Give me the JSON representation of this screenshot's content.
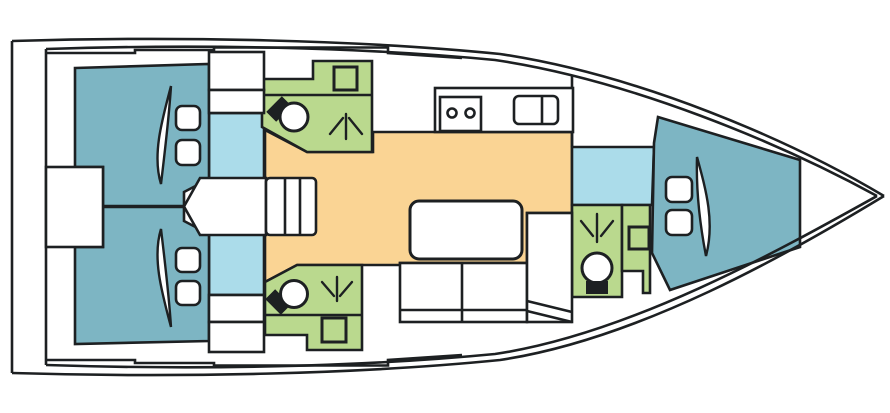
{
  "diagram": {
    "type": "yacht-deck-plan",
    "orientation": "bow-right"
  },
  "colors": {
    "outline": "#1d2022",
    "cabin": "#7db5c3",
    "passage": "#abdcea",
    "head": "#bad98e",
    "saloon": "#fad494",
    "furniture": "#ffffff",
    "background": "#ffffff"
  },
  "icons": {
    "toilet": "toilet-icon",
    "shower": "shower-spray-icon",
    "sink": "sink-icon",
    "stove": "stove-two-burner-icon",
    "galley_sink": "double-sink-icon",
    "steps": "companionway-steps-icon",
    "pillow": "pillow-icon",
    "mattress": "mattress-curve-icon"
  }
}
